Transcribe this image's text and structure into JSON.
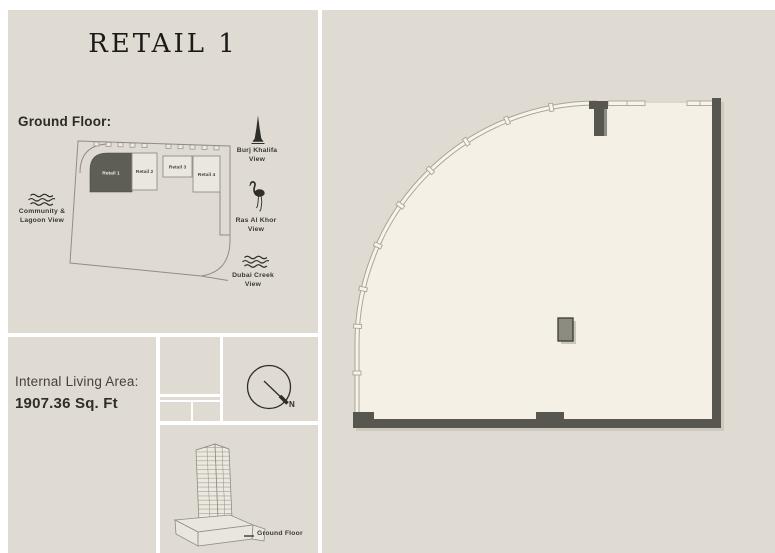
{
  "page": {
    "title": "RETAIL 1"
  },
  "keyplan": {
    "heading": "Ground Floor:",
    "units": [
      {
        "label": "Retail 1",
        "highlighted": true
      },
      {
        "label": "Retail 2",
        "highlighted": false
      },
      {
        "label": "Retail 3",
        "highlighted": false
      },
      {
        "label": "Retail 4",
        "highlighted": false
      }
    ],
    "views": [
      {
        "name": "burj-khalifa",
        "line1": "Burj Khalifa",
        "line2": "View"
      },
      {
        "name": "ras-al-khor",
        "line1": "Ras Al Khor",
        "line2": "View"
      },
      {
        "name": "dubai-creek",
        "line1": "Dubai Creek",
        "line2": "View"
      },
      {
        "name": "community-lagoon",
        "line1": "Community &",
        "line2": "Lagoon View"
      }
    ]
  },
  "area": {
    "label": "Internal Living Area:",
    "value": "1907.36 Sq. Ft"
  },
  "compass": {
    "north": "N"
  },
  "building": {
    "caption": "Ground Floor"
  },
  "colors": {
    "panel": "#dfdbd2",
    "floor": "#f5f0e5",
    "wall": "#57564f",
    "highlight": "#5f5e56",
    "line": "#918e85"
  }
}
